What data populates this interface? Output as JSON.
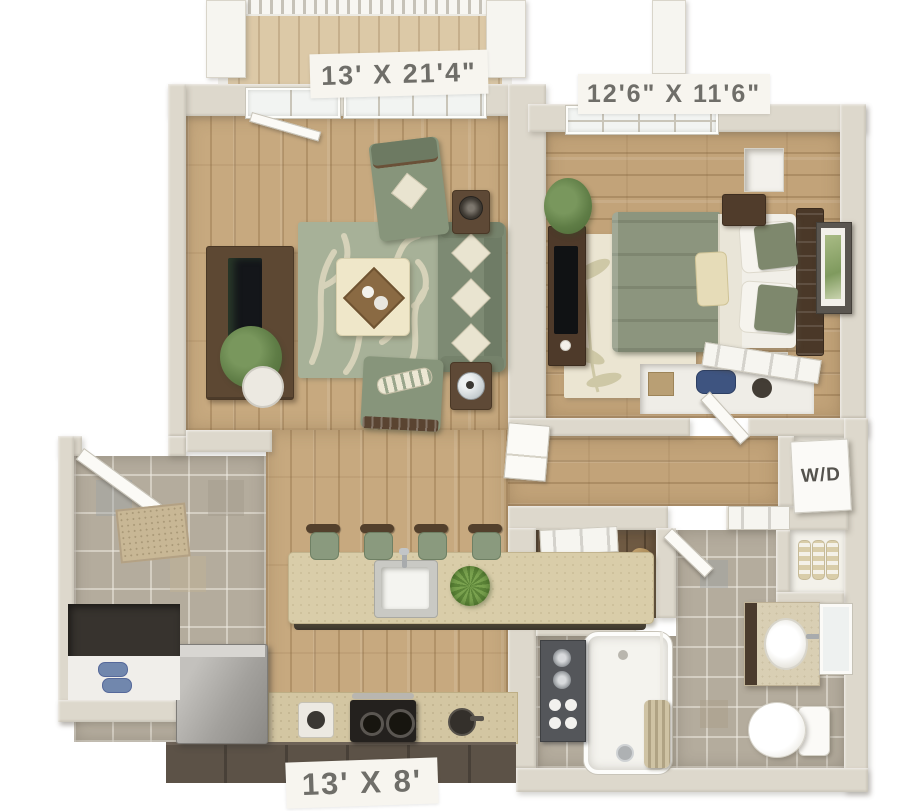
{
  "labels": {
    "living_room_dimensions": "13' X 21'4\"",
    "bedroom_dimensions": "12'6\"  X 11'6\"",
    "kitchen_dimensions": "13' X 8'",
    "washer_dryer": "W/D"
  },
  "colors": {
    "background": "#ffffff",
    "wall": "#ddd8cc",
    "living_wood_floor": "#c7a97f",
    "bedroom_wood_floor": "#c2a379",
    "tile_floor": "#b4ac9d",
    "sage_upholstery": "#7d8a73",
    "rug_sage": "#a7b198",
    "rug_cream": "#ebe5d2",
    "counter_beige": "#d9cda9",
    "cabinet_dark": "#5c5247",
    "wood_furniture": "#5d4833",
    "label_text": "#6f6e69"
  }
}
